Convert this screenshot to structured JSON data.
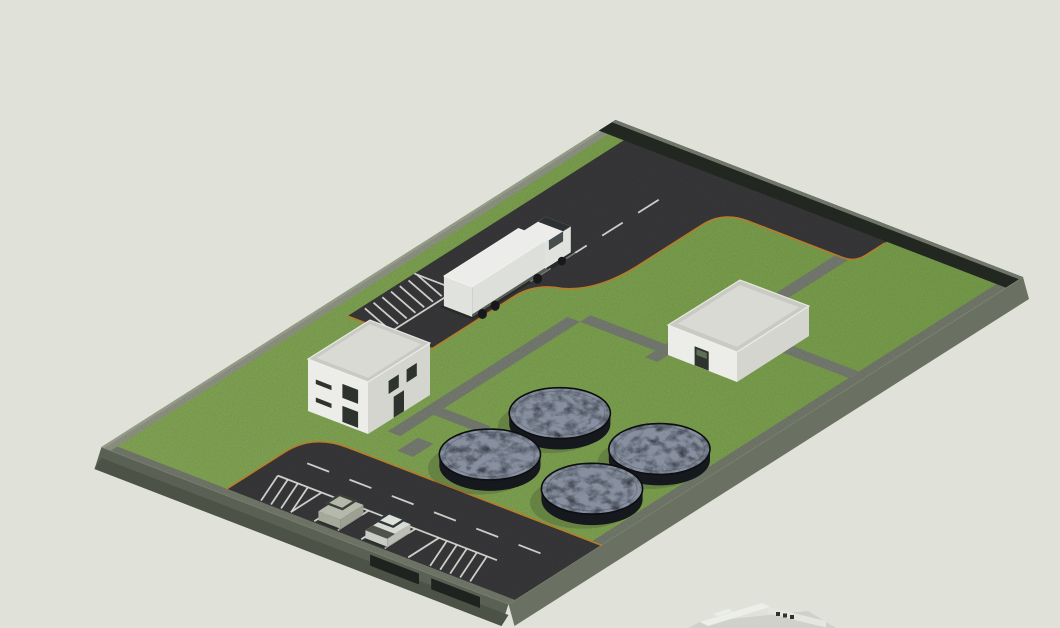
{
  "scene": {
    "title": "Isometric 3D architectural render of a fenced industrial / treatment facility site",
    "view": "axonometric bird's-eye view from the south-west",
    "background_color": "#e0e2da"
  },
  "site": {
    "boundary": "rectangular plot on a raised slab with dark perimeter wall along the north-east edge",
    "ground_surfaces": [
      "lawn",
      "asphalt truck yard",
      "asphalt parking lot",
      "grey concrete footpaths"
    ],
    "curb_color": "#c9882e",
    "road_marking_color": "#eef0e9"
  },
  "objects": {
    "buildings": [
      {
        "name": "two-storey office building",
        "storeys": 2,
        "roof": "flat with parapet",
        "facade": "white",
        "openings": "strip windows, vertical windows and a door on the two visible facades"
      },
      {
        "name": "single-storey utility building",
        "storeys": 1,
        "roof": "flat with parapet",
        "facade": "white",
        "openings": "glazed double door on the south-west face"
      },
      {
        "name": "neighbouring building, partially visible at the bottom image edge"
      }
    ],
    "tanks": {
      "count": 4,
      "shape": "circular",
      "arrangement": "2 x 2 grid on the lawn",
      "surface": "dark rough texture (sludge / water)"
    },
    "vehicles": [
      {
        "type": "semi-trailer truck",
        "color": "white",
        "location": "loading road in the upper yard"
      },
      {
        "type": "open jeep / SUV",
        "color": "light grey",
        "location": "parking stall"
      },
      {
        "type": "pickup truck",
        "color": "silver",
        "location": "parking stall"
      }
    ],
    "parking": {
      "stalls": 5,
      "occupied": 2,
      "markings": [
        "dashed centre line",
        "white stall lines",
        "hatched no-parking zones"
      ]
    },
    "gates": {
      "count": 2,
      "location": "south-west slab edge near the site entrance"
    }
  },
  "colors": {
    "background": "#e0e2da",
    "slab_side": "#5a6053",
    "slab_side_dark": "#4c5246",
    "slab_side_right": "#6b7162",
    "wall_dark": "#262b24",
    "wall_dark_top": "#7b8173",
    "wall_light": "#949a89",
    "wall_light_top": "#a3a995",
    "band_gray": "#777d6f",
    "grass": "#7ba24d",
    "grass_light": "#88ac58",
    "asphalt": "#3a3a3c",
    "path_gray": "#7a8075",
    "curb_orange": "#c9882e",
    "marking_white": "#eef0e9",
    "tank_top": "#232830",
    "tank_side": "#15181d",
    "tank_texture_tint": "#525c6e",
    "tank_rim": "#0c0e11",
    "building_light": "#ecede8",
    "building_shade": "#d4d5cf",
    "roof": "#c9cac4",
    "roof_inner": "#d9dad4",
    "window_dark": "#2e332d",
    "door_glass": "#5d6f55",
    "truck_white": "#ecedea",
    "glass_dark": "#2c3134",
    "tire_black": "#17181a",
    "suv_gray": "#b5b9ac",
    "pickup_silver": "#d8dad4",
    "shadow": "#1c1d1c",
    "gate_dark": "#1f221f"
  }
}
